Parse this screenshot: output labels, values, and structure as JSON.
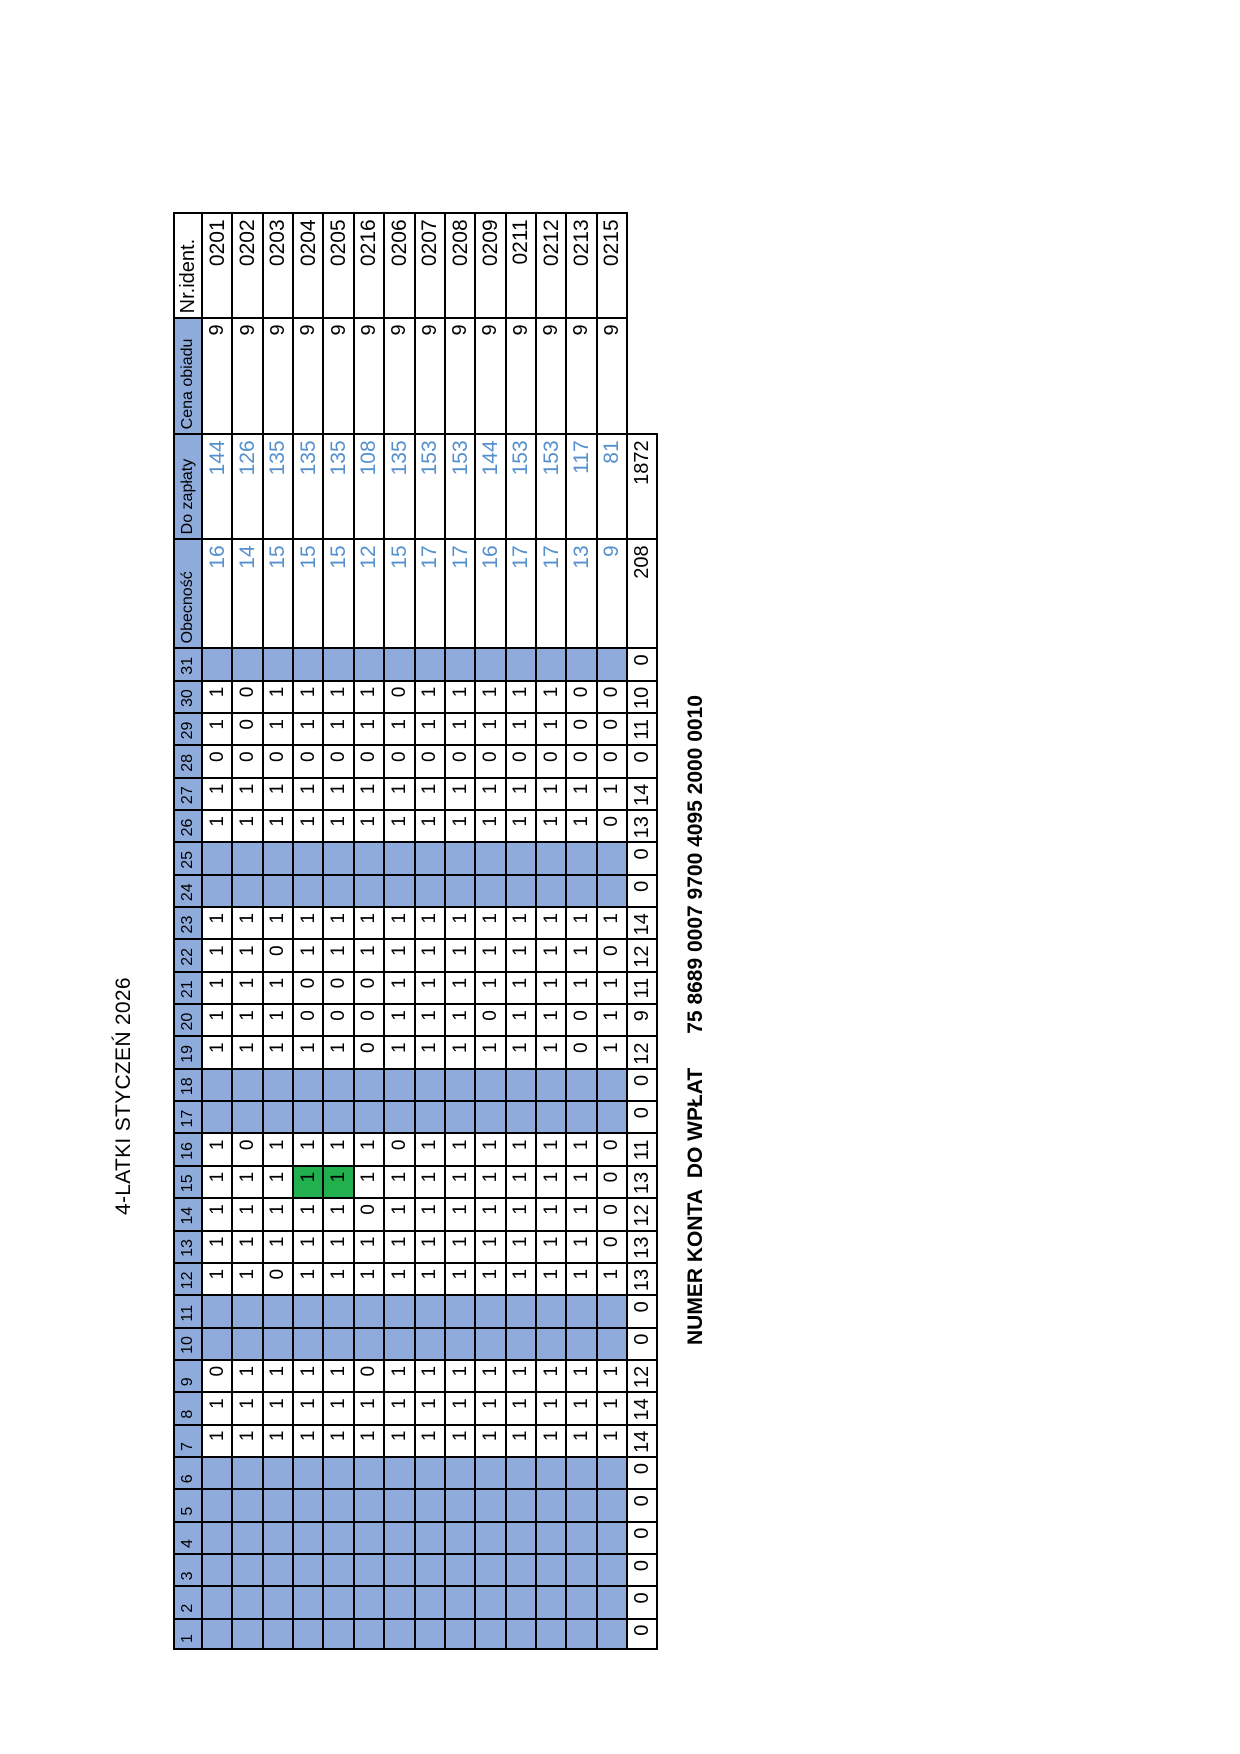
{
  "title": "4-LATKI STYCZEŃ 2026",
  "account": {
    "label": "NUMER KONTA  DO WPŁAT",
    "number": "75 8689 0007 9700 4095 2000 0010"
  },
  "colors": {
    "header_fill": "#8FABDC",
    "closed_fill": "#8FABDC",
    "highlight_fill": "#21B04D",
    "value_text": "#5590CE"
  },
  "table": {
    "days": [
      1,
      2,
      3,
      4,
      5,
      6,
      7,
      8,
      9,
      10,
      11,
      12,
      13,
      14,
      15,
      16,
      17,
      18,
      19,
      20,
      21,
      22,
      23,
      24,
      25,
      26,
      27,
      28,
      29,
      30,
      31
    ],
    "attribute_headers": [
      "Obecność",
      "Do zapłaty",
      "Cena obiadu",
      "Nr.ident."
    ],
    "closed_days": [
      1,
      2,
      3,
      4,
      5,
      6,
      10,
      11,
      17,
      18,
      24,
      25,
      31
    ],
    "highlight": {
      "day": 15,
      "child_ids": [
        "0204",
        "0205"
      ]
    },
    "children": [
      {
        "id": "0201",
        "price": 9,
        "due": 144,
        "attendance": 16,
        "days": [
          null,
          null,
          null,
          null,
          null,
          null,
          1,
          1,
          0,
          null,
          null,
          1,
          1,
          1,
          1,
          1,
          null,
          null,
          1,
          1,
          1,
          1,
          1,
          null,
          null,
          1,
          1,
          0,
          1,
          1,
          null
        ]
      },
      {
        "id": "0202",
        "price": 9,
        "due": 126,
        "attendance": 14,
        "days": [
          null,
          null,
          null,
          null,
          null,
          null,
          1,
          1,
          1,
          null,
          null,
          1,
          1,
          1,
          1,
          0,
          null,
          null,
          1,
          1,
          1,
          1,
          1,
          null,
          null,
          1,
          1,
          0,
          0,
          0,
          null
        ]
      },
      {
        "id": "0203",
        "price": 9,
        "due": 135,
        "attendance": 15,
        "days": [
          null,
          null,
          null,
          null,
          null,
          null,
          1,
          1,
          1,
          null,
          null,
          0,
          1,
          1,
          1,
          1,
          null,
          null,
          1,
          1,
          1,
          0,
          1,
          null,
          null,
          1,
          1,
          0,
          1,
          1,
          null
        ]
      },
      {
        "id": "0204",
        "price": 9,
        "due": 135,
        "attendance": 15,
        "days": [
          null,
          null,
          null,
          null,
          null,
          null,
          1,
          1,
          1,
          null,
          null,
          1,
          1,
          1,
          1,
          1,
          null,
          null,
          1,
          0,
          0,
          1,
          1,
          null,
          null,
          1,
          1,
          0,
          1,
          1,
          null
        ]
      },
      {
        "id": "0205",
        "price": 9,
        "due": 135,
        "attendance": 15,
        "days": [
          null,
          null,
          null,
          null,
          null,
          null,
          1,
          1,
          1,
          null,
          null,
          1,
          1,
          1,
          1,
          1,
          null,
          null,
          1,
          0,
          0,
          1,
          1,
          null,
          null,
          1,
          1,
          0,
          1,
          1,
          null
        ]
      },
      {
        "id": "0216",
        "price": 9,
        "due": 108,
        "attendance": 12,
        "days": [
          null,
          null,
          null,
          null,
          null,
          null,
          1,
          1,
          0,
          null,
          null,
          1,
          1,
          0,
          1,
          1,
          null,
          null,
          0,
          0,
          0,
          1,
          1,
          null,
          null,
          1,
          1,
          0,
          1,
          1,
          null
        ]
      },
      {
        "id": "0206",
        "price": 9,
        "due": 135,
        "attendance": 15,
        "days": [
          null,
          null,
          null,
          null,
          null,
          null,
          1,
          1,
          1,
          null,
          null,
          1,
          1,
          1,
          1,
          0,
          null,
          null,
          1,
          1,
          1,
          1,
          1,
          null,
          null,
          1,
          1,
          0,
          1,
          0,
          null
        ]
      },
      {
        "id": "0207",
        "price": 9,
        "due": 153,
        "attendance": 17,
        "days": [
          null,
          null,
          null,
          null,
          null,
          null,
          1,
          1,
          1,
          null,
          null,
          1,
          1,
          1,
          1,
          1,
          null,
          null,
          1,
          1,
          1,
          1,
          1,
          null,
          null,
          1,
          1,
          0,
          1,
          1,
          null
        ]
      },
      {
        "id": "0208",
        "price": 9,
        "due": 153,
        "attendance": 17,
        "days": [
          null,
          null,
          null,
          null,
          null,
          null,
          1,
          1,
          1,
          null,
          null,
          1,
          1,
          1,
          1,
          1,
          null,
          null,
          1,
          1,
          1,
          1,
          1,
          null,
          null,
          1,
          1,
          0,
          1,
          1,
          null
        ]
      },
      {
        "id": "0209",
        "price": 9,
        "due": 144,
        "attendance": 16,
        "days": [
          null,
          null,
          null,
          null,
          null,
          null,
          1,
          1,
          1,
          null,
          null,
          1,
          1,
          1,
          1,
          1,
          null,
          null,
          1,
          0,
          1,
          1,
          1,
          null,
          null,
          1,
          1,
          0,
          1,
          1,
          null
        ]
      },
      {
        "id": "0211",
        "price": 9,
        "due": 153,
        "attendance": 17,
        "days": [
          null,
          null,
          null,
          null,
          null,
          null,
          1,
          1,
          1,
          null,
          null,
          1,
          1,
          1,
          1,
          1,
          null,
          null,
          1,
          1,
          1,
          1,
          1,
          null,
          null,
          1,
          1,
          0,
          1,
          1,
          null
        ]
      },
      {
        "id": "0212",
        "price": 9,
        "due": 153,
        "attendance": 17,
        "days": [
          null,
          null,
          null,
          null,
          null,
          null,
          1,
          1,
          1,
          null,
          null,
          1,
          1,
          1,
          1,
          1,
          null,
          null,
          1,
          1,
          1,
          1,
          1,
          null,
          null,
          1,
          1,
          0,
          1,
          1,
          null
        ]
      },
      {
        "id": "0213",
        "price": 9,
        "due": 117,
        "attendance": 13,
        "days": [
          null,
          null,
          null,
          null,
          null,
          null,
          1,
          1,
          1,
          null,
          null,
          1,
          1,
          1,
          1,
          1,
          null,
          null,
          0,
          0,
          1,
          1,
          1,
          null,
          null,
          1,
          1,
          0,
          0,
          0,
          null
        ]
      },
      {
        "id": "0215",
        "price": 9,
        "due": 81,
        "attendance": 9,
        "days": [
          null,
          null,
          null,
          null,
          null,
          null,
          1,
          1,
          1,
          null,
          null,
          1,
          0,
          0,
          0,
          0,
          null,
          null,
          1,
          1,
          1,
          0,
          1,
          null,
          null,
          0,
          1,
          0,
          0,
          0,
          null
        ]
      }
    ],
    "totals": {
      "attendance": 208,
      "due": 1872,
      "per_day": [
        0,
        0,
        0,
        0,
        0,
        0,
        14,
        14,
        12,
        0,
        0,
        13,
        13,
        12,
        13,
        11,
        0,
        0,
        12,
        9,
        11,
        12,
        14,
        0,
        0,
        13,
        14,
        0,
        11,
        10,
        0
      ]
    }
  }
}
